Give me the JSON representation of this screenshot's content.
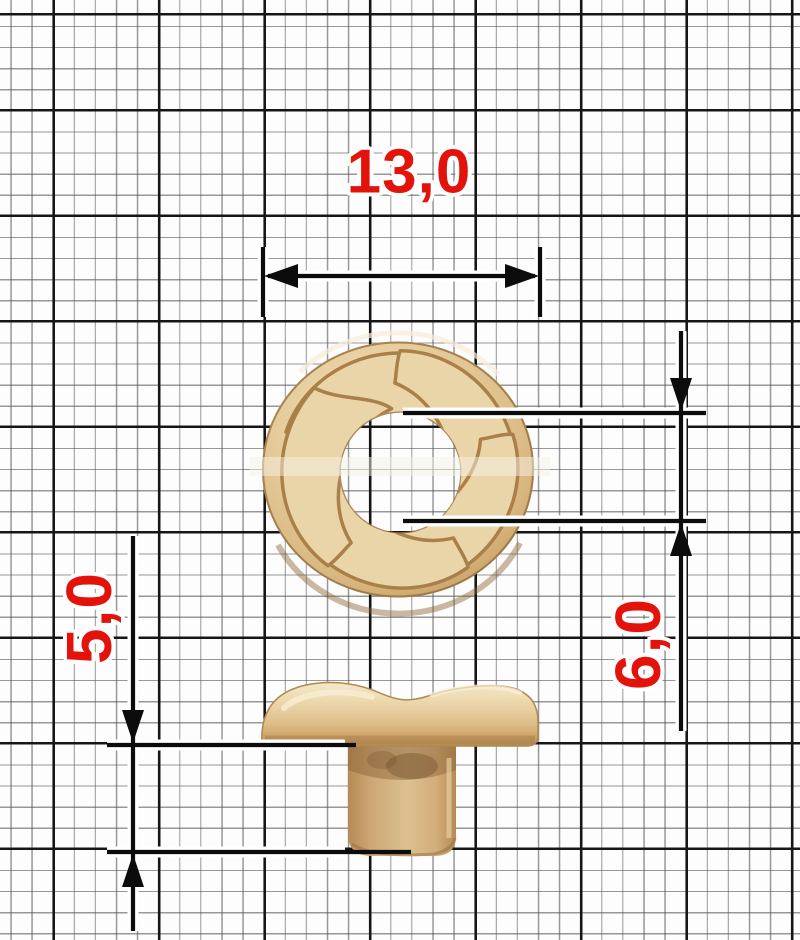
{
  "document": {
    "kind": "technical dimension drawing of a metal button/rivet fitting on millimeter graph paper"
  },
  "dimensions": {
    "width": {
      "label": "13,0"
    },
    "stem_height": {
      "label": "5,0"
    },
    "hole": {
      "label": "6,0"
    }
  },
  "style": {
    "dimension_text_color": "#e3130c",
    "dimension_line_color": "#0c0c0c",
    "grid_minor_color": "#5a5a5a",
    "grid_major_color": "#161616",
    "metal_highlight": "#f4e7c8",
    "metal_base": "#e4c795",
    "metal_shadow": "#a97c45",
    "paper_color": "#fdfdfd"
  }
}
